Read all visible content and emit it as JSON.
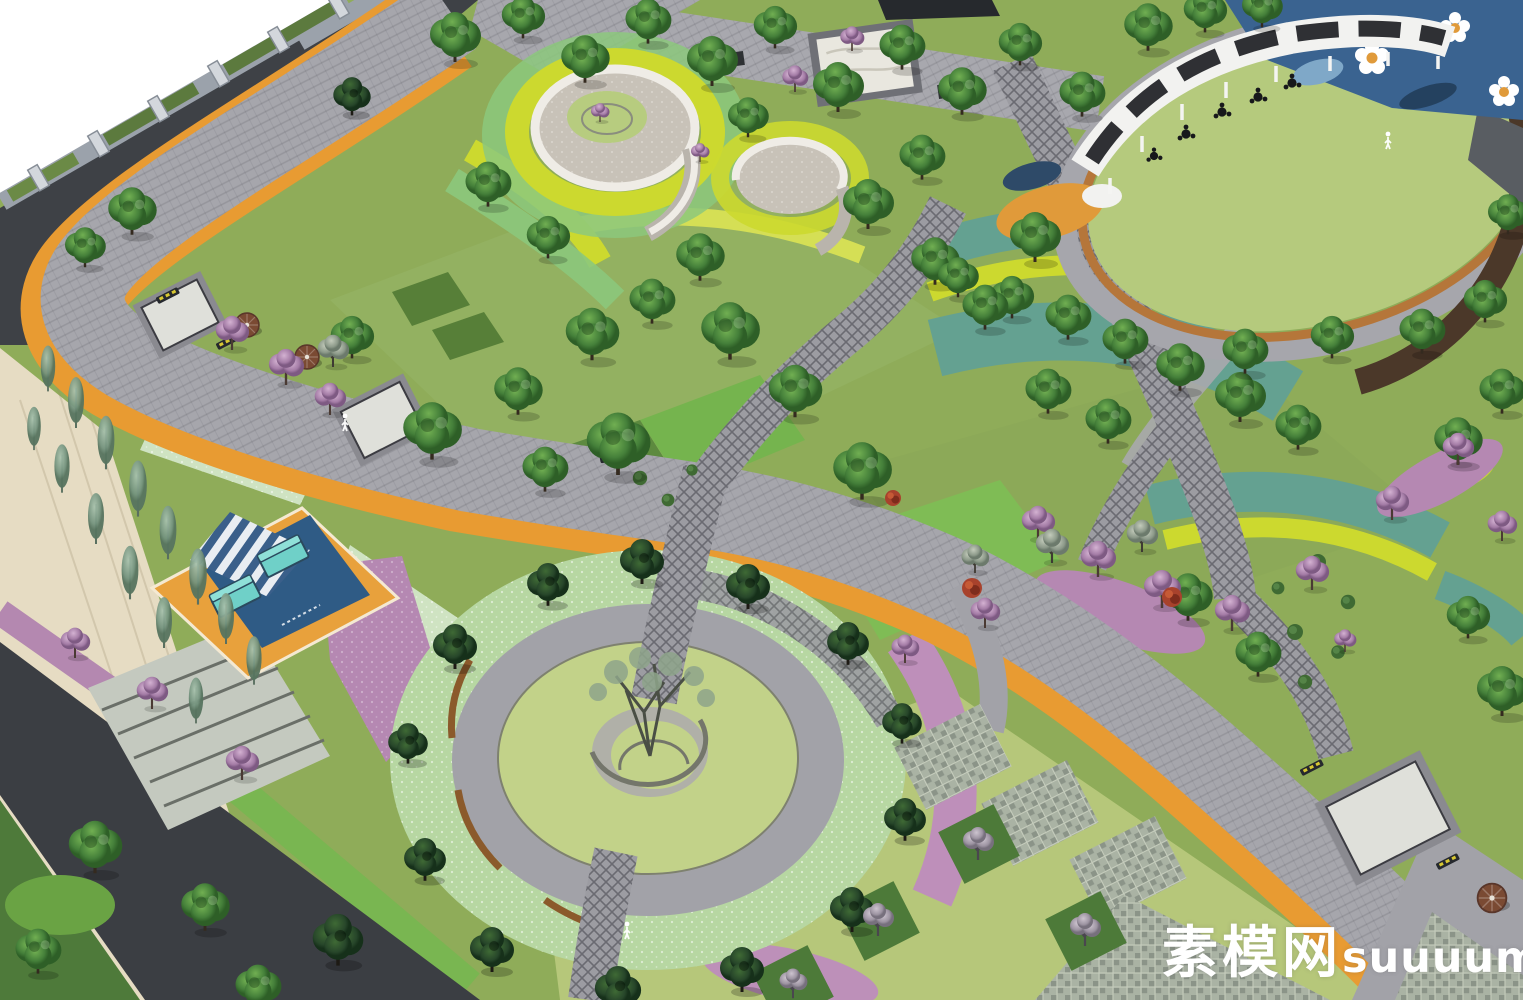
{
  "watermark": {
    "site_name": "素模网",
    "site_domain": "suuuum.com"
  },
  "palette": {
    "background_white": "#FFFFFF",
    "accent_orange_path_edge": "#E89B32",
    "asphalt_road": "#3E4146",
    "paving_grey": "#A6A6AC",
    "lattice_path_grey": "#9C9CA2",
    "lawn_olive": "#8FAC59",
    "lawn_light_plaza": "#C2D289",
    "groundcover_speckled": "#B7D7A2",
    "shrub_yellow_green": "#CCD92F",
    "shrub_teal": "#64A191",
    "blossom_purple": "#B286B4",
    "pine_dark_green": "#2D4E2B",
    "tree_green": "#4E8C3C",
    "playground_blue": "#3A6390",
    "sand_orange": "#E09A3A",
    "pavement_beige": "#E6DCC3",
    "canopy_white": "#F2F2F0",
    "bench_wood_brown": "#8B5A2B",
    "platform_teal_bench": "#6FD0C8",
    "watermark_white": "#FFFFFF"
  }
}
